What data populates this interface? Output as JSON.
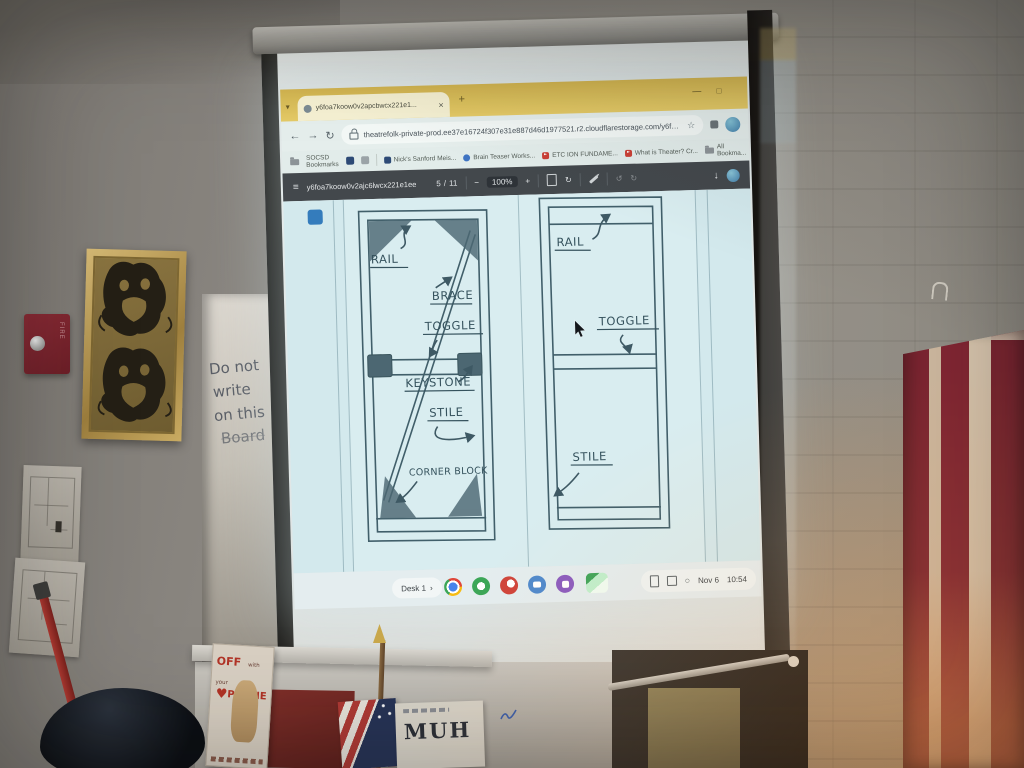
{
  "browser": {
    "tab": {
      "title": "y6foa7koow0v2apcbwcx221e1..."
    },
    "url": "theatrefolk-private-prod.ee37e16724f307e31e887d46d1977521.r2.cloudflarestorage.com/y6foa7koow0v2apcbwcx...",
    "bookmarks_bar": {
      "folder_label": "SOCSD Bookmarks",
      "items": [
        "Nick's Sanford Meis...",
        "Brain Teaser Works...",
        "ETC ION FUNDAME...",
        "What is Theater? Cr..."
      ],
      "all_bookmarks": "All Bookma..."
    }
  },
  "pdf": {
    "filename": "y6foa7koow0v2ajc6lwcx221e1ee",
    "page_current": "5",
    "page_divider": "/",
    "page_total": "11",
    "zoom_level": "100%"
  },
  "diagram": {
    "left_flat": {
      "rail": "RAIL",
      "brace": "BRACE",
      "toggle": "TOGGLE",
      "keystone": "KEYSTONE",
      "stile": "STILE",
      "corner_block": "CORNER BLOCK"
    },
    "right_flat": {
      "rail": "RAIL",
      "toggle": "TOGGLE",
      "stile": "STILE"
    }
  },
  "shelf": {
    "desk_label": "Desk 1",
    "date": "Nov 6",
    "time": "10:54",
    "app_icons": [
      "chrome-icon",
      "green-app-icon",
      "red-app-icon",
      "blue-app-icon",
      "purple-app-icon",
      "files-app-icon"
    ]
  },
  "room": {
    "whiteboard_note_lines": [
      "Do not",
      "write",
      "on this",
      "Board"
    ],
    "phone_poster": {
      "word1": "OFF",
      "word2": "with your",
      "word3": "PHONE"
    },
    "flag_sign_text": "MUH",
    "fire_alarm_label": "FIRE"
  },
  "glyphs": {
    "chevron_down": "▾",
    "close": "×",
    "plus": "+",
    "minimize": "—",
    "maximize": "□",
    "back": "←",
    "forward": "→",
    "reload": "↻",
    "star": "☆",
    "menu": "≡",
    "minus": "−",
    "rotate": "↻",
    "undo": "↺",
    "redo": "↻",
    "download": "↓",
    "chevron_right": "›",
    "heart": "♥"
  },
  "colors": {
    "chrome_theme_yellow": "#e2c052",
    "pdf_toolbar": "#383e43",
    "page_tint": "#d2e9ee",
    "ink": "#33525e",
    "flag_red": "#7c2531",
    "flag_cream": "#d9c6ae",
    "wall_grey": "#8b8781"
  }
}
